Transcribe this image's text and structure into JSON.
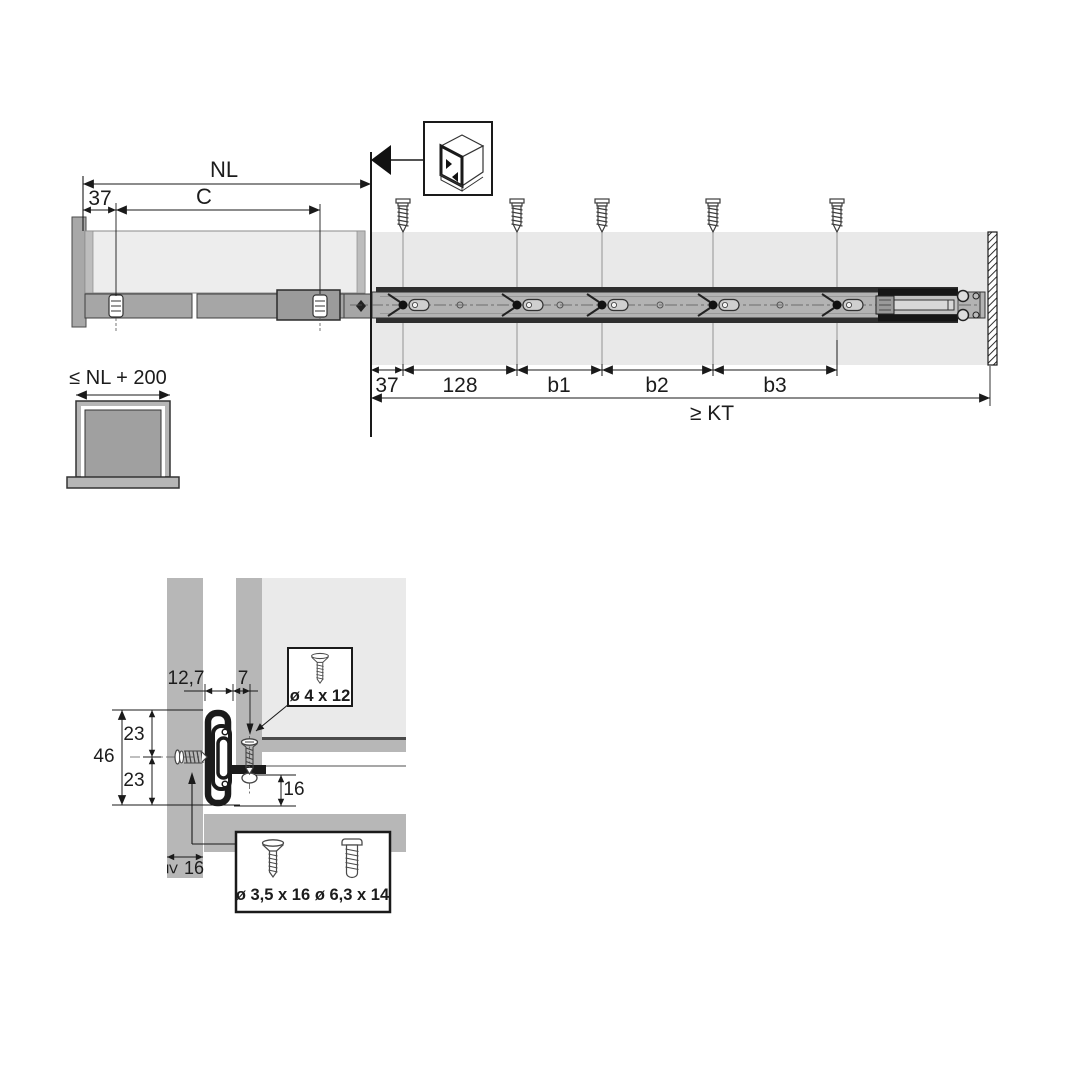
{
  "colors": {
    "line": "#1a1a1a",
    "panel_gray": "#b7b7b7",
    "band_gray": "#e9e9e9",
    "drawer_body": "#ededed",
    "rail_gray": "#b3b3b3",
    "rail_dark_edge": "#2e2e2e"
  },
  "top_view": {
    "nl": "NL",
    "front_offset": "37",
    "c": "C",
    "segments": [
      "37",
      "128",
      "b1",
      "b2",
      "b3"
    ],
    "kt": "≥ KT"
  },
  "front_view": {
    "max_width": "≤ NL + 200"
  },
  "cross_section": {
    "slide_thickness": "12,7",
    "screw_offset": "7",
    "slide_height": "46",
    "half_upper": "23",
    "half_lower": "23",
    "bottom_clearance": "16",
    "min_panel_symbol": "≥",
    "min_panel_value": "16",
    "drawer_screw": "ø 4 x 12",
    "side_screw": "ø 3,5 x 16",
    "press_screw": "ø 6,3 x 14"
  },
  "icons": {
    "cabinet_icon": "cabinet-inner-side-mount-icon",
    "screw_icon": "mounting-screw-icon",
    "wall_hatch": "cabinet-front-edge-hatch"
  }
}
